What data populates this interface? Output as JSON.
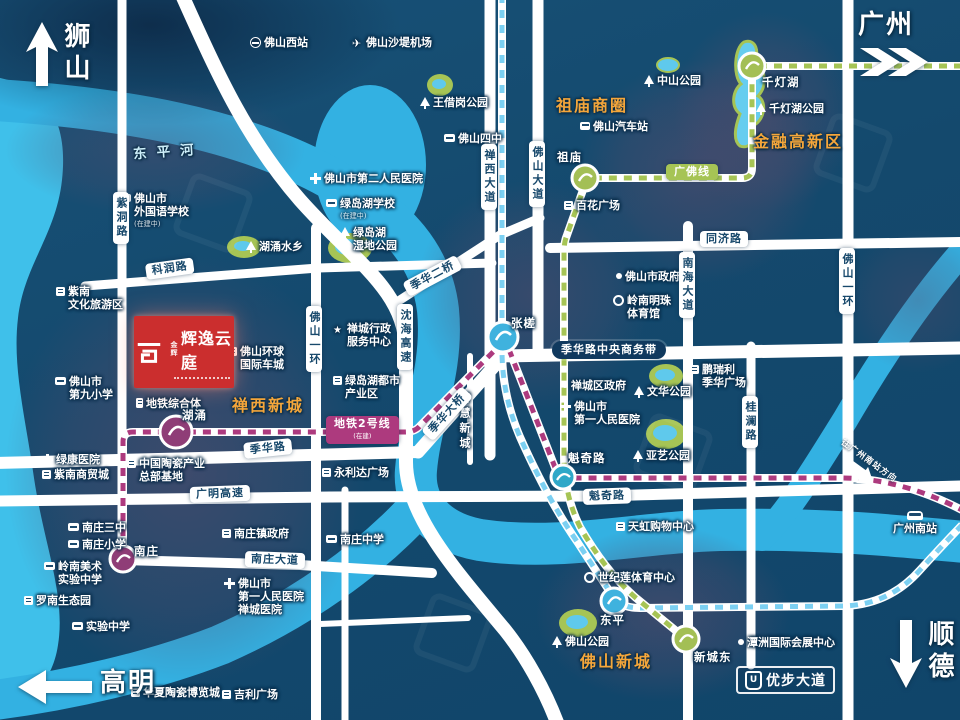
{
  "map": {
    "directions": {
      "nw": "狮山",
      "ne": "广州",
      "sw": "高明",
      "se": "顺德",
      "to_gz_south": "往广州南站方向"
    },
    "logo": {
      "brand": "金辉",
      "name": "辉逸云庭"
    },
    "ubu_logo": "优步大道",
    "colors": {
      "accent_red": "#cb2e2e",
      "orange": "#f4a63b",
      "line2_purple": "#ad3a7e",
      "guangfo_green": "#a6c455",
      "blue_line": "#7cd0f2",
      "water": "#33b1e2",
      "road": "#ffffff"
    },
    "metro": {
      "line2": {
        "label": "地铁2号线",
        "sub": "(在建)",
        "color": "#ad3a7e"
      },
      "guangfo": {
        "label": "广佛线",
        "color": "#a6c455"
      },
      "blue_line": {
        "color": "#7cd0f2"
      }
    },
    "area_labels": [
      {
        "x": 556,
        "y": 92,
        "t": "祖庙商圈"
      },
      {
        "x": 753,
        "y": 128,
        "t": "金融高新区"
      },
      {
        "x": 232,
        "y": 392,
        "t": "禅西新城"
      },
      {
        "x": 580,
        "y": 648,
        "t": "佛山新城"
      },
      {
        "x": 133,
        "y": 140,
        "t": "东平河",
        "cls": "river"
      }
    ],
    "road_badges": [
      {
        "x": 146,
        "y": 264,
        "t": "科润路",
        "rot": -8
      },
      {
        "x": 113,
        "y": 192,
        "t": "紫洞路",
        "v": 1
      },
      {
        "x": 481,
        "y": 144,
        "t": "禅西大道",
        "v": 1
      },
      {
        "x": 529,
        "y": 141,
        "t": "佛山大道",
        "v": 1
      },
      {
        "x": 397,
        "y": 304,
        "t": "沈海高速",
        "v": 1
      },
      {
        "x": 306,
        "y": 306,
        "t": "佛山一环",
        "v": 1
      },
      {
        "x": 839,
        "y": 248,
        "t": "佛山一环",
        "v": 1
      },
      {
        "x": 679,
        "y": 252,
        "t": "南海大道",
        "v": 1
      },
      {
        "x": 742,
        "y": 396,
        "t": "桂澜路",
        "v": 1
      },
      {
        "x": 700,
        "y": 231,
        "t": "同济路"
      },
      {
        "x": 406,
        "y": 282,
        "t": "季华二桥",
        "rot": -28
      },
      {
        "x": 427,
        "y": 428,
        "t": "季华大桥",
        "rot": -48
      },
      {
        "x": 244,
        "y": 443,
        "t": "季华路",
        "rot": -6
      },
      {
        "x": 190,
        "y": 487,
        "t": "广明高速",
        "rot": -2
      },
      {
        "x": 245,
        "y": 551,
        "t": "南庄大道",
        "rot": 2
      },
      {
        "x": 583,
        "y": 489,
        "t": "魁奇路",
        "rot": -2
      },
      {
        "x": 552,
        "y": 341,
        "t": "季华路中央商务带",
        "type": "dark"
      },
      {
        "x": 326,
        "y": 416,
        "t": "地铁2号线",
        "type": "m2",
        "sub": "(在建)"
      },
      {
        "x": 666,
        "y": 164,
        "t": "广佛线",
        "type": "gf"
      }
    ],
    "pois": [
      {
        "x": 250,
        "y": 36,
        "icon": "station",
        "lines": [
          "佛山西站"
        ]
      },
      {
        "x": 352,
        "y": 36,
        "icon": "plane",
        "lines": [
          "佛山沙堤机场"
        ]
      },
      {
        "x": 120,
        "y": 192,
        "icon": "school",
        "lines": [
          "佛山市",
          "外国语学校",
          "(在建中)"
        ]
      },
      {
        "x": 420,
        "y": 96,
        "icon": "tree",
        "lines": [
          "王借岗公园"
        ]
      },
      {
        "x": 444,
        "y": 132,
        "icon": "school",
        "lines": [
          "佛山四中"
        ]
      },
      {
        "x": 246,
        "y": 240,
        "icon": "tree",
        "lines": [
          "湖涌水乡"
        ]
      },
      {
        "x": 310,
        "y": 172,
        "icon": "hosp",
        "lines": [
          "佛山市第二人民医院"
        ]
      },
      {
        "x": 326,
        "y": 197,
        "icon": "school",
        "lines": [
          "绿岛湖学校",
          "(在建中)"
        ]
      },
      {
        "x": 340,
        "y": 226,
        "icon": "tree",
        "lines": [
          "绿岛湖",
          "湿地公园"
        ]
      },
      {
        "x": 644,
        "y": 74,
        "icon": "tree",
        "lines": [
          "中山公园"
        ]
      },
      {
        "x": 580,
        "y": 120,
        "icon": "bus",
        "lines": [
          "佛山汽车站"
        ]
      },
      {
        "x": 564,
        "y": 199,
        "icon": "bldg",
        "lines": [
          "百花广场"
        ]
      },
      {
        "x": 762,
        "y": 76,
        "cls": "st",
        "lines": [
          "千灯湖"
        ]
      },
      {
        "x": 756,
        "y": 102,
        "icon": "tree",
        "lines": [
          "千灯湖公园"
        ]
      },
      {
        "x": 56,
        "y": 285,
        "icon": "bldg",
        "lines": [
          "紫南",
          "文化旅游区"
        ]
      },
      {
        "x": 55,
        "y": 375,
        "icon": "school",
        "lines": [
          "佛山市",
          "第九小学"
        ]
      },
      {
        "x": 136,
        "y": 397,
        "icon": "metro",
        "lines": [
          "地铁综合体"
        ]
      },
      {
        "x": 228,
        "y": 345,
        "icon": "bldg",
        "lines": [
          "佛山环球",
          "国际车城"
        ]
      },
      {
        "x": 333,
        "y": 322,
        "icon": "star",
        "lines": [
          "禅城行政",
          "服务中心"
        ]
      },
      {
        "x": 333,
        "y": 374,
        "icon": "bldg",
        "lines": [
          "绿岛湖都市",
          "产业区"
        ]
      },
      {
        "x": 127,
        "y": 457,
        "icon": "bldg",
        "lines": [
          "中国陶瓷产业",
          "总部基地"
        ]
      },
      {
        "x": 42,
        "y": 453,
        "icon": "hosp",
        "lines": [
          "绿康医院"
        ]
      },
      {
        "x": 42,
        "y": 468,
        "icon": "bldg",
        "lines": [
          "紫南商贸城"
        ]
      },
      {
        "x": 322,
        "y": 466,
        "icon": "bldg",
        "lines": [
          "永利达广场"
        ]
      },
      {
        "x": 458,
        "y": 392,
        "cls": "vtext",
        "lines": [
          "智慧新城"
        ]
      },
      {
        "x": 562,
        "y": 379,
        "icon": "dot",
        "lines": [
          "禅城区政府"
        ]
      },
      {
        "x": 560,
        "y": 400,
        "icon": "hosp",
        "lines": [
          "佛山市",
          "第一人民医院"
        ]
      },
      {
        "x": 616,
        "y": 270,
        "icon": "dot",
        "lines": [
          "佛山市政府"
        ]
      },
      {
        "x": 613,
        "y": 294,
        "icon": "ring",
        "lines": [
          "岭南明珠",
          "体育馆"
        ]
      },
      {
        "x": 634,
        "y": 385,
        "icon": "tree",
        "lines": [
          "文华公园"
        ]
      },
      {
        "x": 633,
        "y": 449,
        "icon": "tree",
        "lines": [
          "亚艺公园"
        ]
      },
      {
        "x": 690,
        "y": 363,
        "icon": "bldg",
        "lines": [
          "鹏瑞利",
          "季华广场"
        ]
      },
      {
        "x": 568,
        "y": 452,
        "cls": "st",
        "lines": [
          "魁奇路"
        ]
      },
      {
        "x": 616,
        "y": 520,
        "icon": "bldg",
        "lines": [
          "天虹购物中心"
        ]
      },
      {
        "x": 584,
        "y": 571,
        "icon": "ring",
        "lines": [
          "世纪莲体育中心"
        ]
      },
      {
        "x": 600,
        "y": 614,
        "cls": "st",
        "lines": [
          "东平"
        ]
      },
      {
        "x": 552,
        "y": 635,
        "icon": "tree",
        "lines": [
          "佛山公园"
        ]
      },
      {
        "x": 694,
        "y": 651,
        "cls": "st",
        "lines": [
          "新城东"
        ]
      },
      {
        "x": 738,
        "y": 636,
        "icon": "dot",
        "lines": [
          "潭洲国际会展中心"
        ]
      },
      {
        "x": 893,
        "y": 511,
        "cls": "col",
        "icon": "hsr",
        "lines": [
          "广州南站"
        ]
      },
      {
        "x": 131,
        "y": 686,
        "icon": "bldg",
        "lines": [
          "华夏陶瓷博览城"
        ]
      },
      {
        "x": 222,
        "y": 688,
        "icon": "bldg",
        "lines": [
          "吉利广场"
        ]
      },
      {
        "x": 68,
        "y": 521,
        "icon": "school",
        "lines": [
          "南庄三中"
        ]
      },
      {
        "x": 68,
        "y": 538,
        "icon": "school",
        "lines": [
          "南庄小学"
        ]
      },
      {
        "x": 134,
        "y": 545,
        "cls": "st",
        "lines": [
          "南庄"
        ]
      },
      {
        "x": 44,
        "y": 560,
        "icon": "school",
        "lines": [
          "岭南美术",
          "实验中学"
        ]
      },
      {
        "x": 24,
        "y": 594,
        "icon": "bldg",
        "lines": [
          "罗南生态园"
        ]
      },
      {
        "x": 72,
        "y": 620,
        "icon": "school",
        "lines": [
          "实验中学"
        ]
      },
      {
        "x": 222,
        "y": 527,
        "icon": "bldg",
        "lines": [
          "南庄镇政府"
        ]
      },
      {
        "x": 224,
        "y": 577,
        "icon": "hosp",
        "lines": [
          "佛山市",
          "第一人民医院",
          "禅城医院"
        ]
      },
      {
        "x": 326,
        "y": 533,
        "icon": "school",
        "lines": [
          "南庄中学"
        ]
      },
      {
        "x": 182,
        "y": 409,
        "cls": "st",
        "lines": [
          "湖涌"
        ]
      },
      {
        "x": 511,
        "y": 317,
        "cls": "st",
        "lines": [
          "张槎"
        ]
      },
      {
        "x": 557,
        "y": 151,
        "cls": "st",
        "lines": [
          "祖庙"
        ]
      }
    ]
  }
}
